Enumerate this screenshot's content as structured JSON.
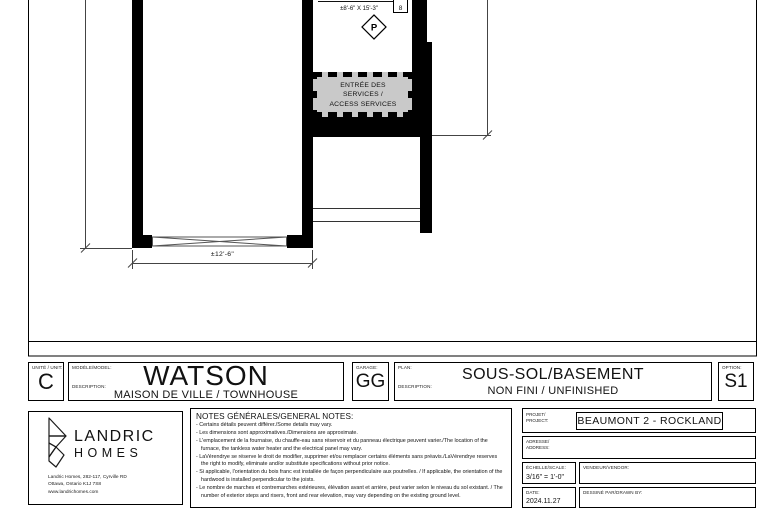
{
  "plan": {
    "room_label_line1": "UNFINISHED ROOM",
    "room_label_line2": "±8'-6\" X 15'-3\"",
    "column_symbol": "P",
    "door_tag": "8",
    "services_area_line1": "ENTRÉE DES",
    "services_area_line2": "SERVICES /",
    "services_area_line3": "ACCESS SERVICES",
    "dimension_width": "±12'-6\""
  },
  "title_block": {
    "unit_label": "UNITÉ / UNIT:",
    "unit_value": "C",
    "model_label": "MODÈLE/MODEL:",
    "model_value": "WATSON",
    "model_description_label": "DESCRIPTION:",
    "model_description": "MAISON DE VILLE / TOWNHOUSE",
    "garage_label": "GARAGE:",
    "garage_value": "GG",
    "plan_label": "PLAN:",
    "plan_value": "SOUS-SOL/BASEMENT",
    "plan_description_label": "DESCRIPTION:",
    "plan_description": "NON FINI / UNFINISHED",
    "option_label": "OPTION:",
    "option_value": "S1"
  },
  "company": {
    "name_line1": "LANDRIC",
    "name_line2": "HOMES",
    "address_line1": "Landric Homes, 282-117, Cyrville RD",
    "address_line2": "Ottawa, Ontario K1J 7S8",
    "address_line3": "www.landrichomes.com"
  },
  "notes": {
    "title": "NOTES GÉNÉRALES/GENERAL NOTES:",
    "items": [
      "- Certains détails peuvent différer./Some details may vary.",
      "- Les dimensions sont approximatives./Dimensions are approximate.",
      "- L'emplacement de la fournaise, du chauffe-eau sans réservoir et du panneau électrique peuvent varier./The location of the furnace, the tankless water heater and the electrical panel may vary.",
      "- LaVérendrye se réserve le droit de modifier, supprimer et/ou remplacer certains éléments sans préavis./LaVérendrye reserves the right to modify, eliminate and/or substitute specifications without prior notice.",
      "- Si applicable, l'orientation du bois franc est installée de façon perpendiculaire aux poutrelles. / If applicable, the orientation of the hardwood is installed perpendicular to the joists.",
      "- Le nombre de marches et contremarches extérieures, élévation avant et arrière, peut varier selon le niveau du sol existant. / The number of exterior steps and risers, front and rear elevation, may vary depending on the existing ground level."
    ]
  },
  "project_info": {
    "project_label_fr": "PROJET/",
    "project_label_en": "PROJECT:",
    "project_value": "BEAUMONT 2 - ROCKLAND",
    "address_label_fr": "ADRESSE/",
    "address_label_en": "ADDRESS:",
    "address_value": "",
    "scale_label": "ÉCHELLE/SCALE:",
    "scale_value": "3/16\" = 1'-0\"",
    "vendor_label": "VENDEUR/VENDOR:",
    "vendor_value": "",
    "date_label": "DATE:",
    "date_value": "2024.11.27",
    "drawn_by_label": "DESSINÉ PAR/DRAWN BY:",
    "drawn_by_value": ""
  },
  "colors": {
    "line": "#000000",
    "hatch_fill": "#c9c9c9",
    "dimension_line": "#444444"
  }
}
